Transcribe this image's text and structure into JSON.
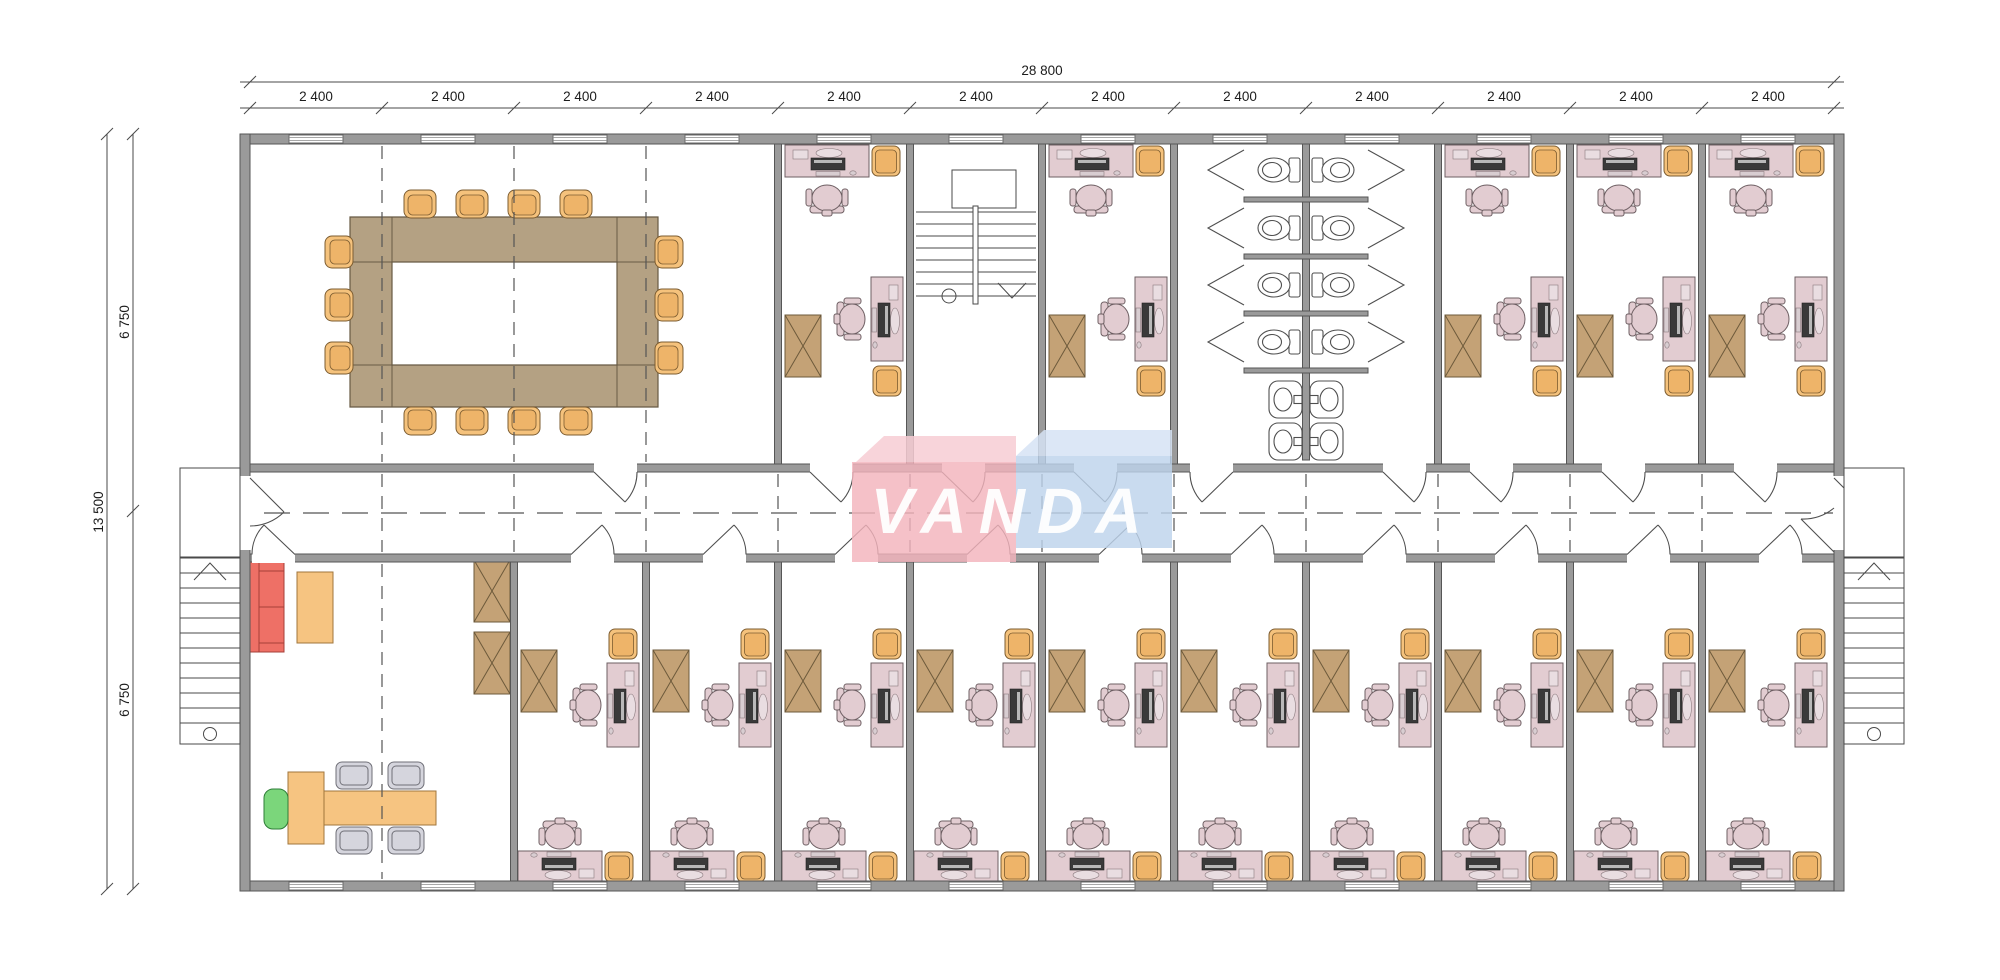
{
  "dimensions": {
    "top_total": "28 800",
    "top_segments": [
      "2 400",
      "2 400",
      "2 400",
      "2 400",
      "2 400",
      "2 400",
      "2 400",
      "2 400",
      "2 400",
      "2 400",
      "2 400",
      "2 400"
    ],
    "left_total": "13 500",
    "left_top": "6 750",
    "left_bottom": "6 750"
  },
  "logo": {
    "text": "VANDA"
  },
  "plan": {
    "overall_width_mm": "28 800",
    "module_width_mm": "2 400",
    "module_count": 12,
    "overall_depth_mm": "13 500",
    "half_depth_mm": "6 750",
    "top_rooms": [
      "conference room (4 modules, table with 14 chairs)",
      "office (desk, task chair, guest chair, wardrobe, side desk)",
      "stairwell (internal stair, down arrow)",
      "office",
      "toilets (2 modules: 8 stalls back-to-back, 4 wash basins)",
      "office",
      "office",
      "office"
    ],
    "bottom_rooms": [
      "reception / lounge (2 modules: sofa, coffee table, manager desk with 4 visitor chairs, 2 wardrobes)",
      "office x10 (wardrobe, side desk, window desk, 2 guest chairs)"
    ],
    "exterior": [
      "entrance stair + landing west",
      "entrance stair + landing east"
    ],
    "corridor": "central corridor with dashed axis line and door swings"
  },
  "palette": {
    "wall": "#9a9a9a",
    "wall_edge": "#565656",
    "line": "#4a4a4a",
    "dash": "#555555",
    "desk": "#e2ccd1",
    "desk_edge": "#6e5f63",
    "desk_monitor": "#3a3a3a",
    "chair_orange": "#f5c27c",
    "chair_orange_in": "#eeb469",
    "chair_orange_edge": "#7c5c30",
    "wardrobe": "#c4a276",
    "wardrobe_edge": "#6d5a3b",
    "conf_table": "#b4a183",
    "conf_table_edge": "#675a44",
    "sofa": "#ee7066",
    "sofa_edge": "#a63f38",
    "table_orange": "#f6c481",
    "table_orange_edge": "#a0763c",
    "chair_green": "#7bd67b",
    "chair_green_edge": "#2f7d38",
    "chair_grey": "#d5d5dd",
    "chair_grey_edge": "#6f6f77",
    "logo_red": "#f3b3bc",
    "logo_red_top": "#f7cdd3",
    "logo_blue": "#bdd3eb",
    "logo_blue_top": "#d6e3f4",
    "logo_text": "#ffffff",
    "dim_text": "#1c1c1c"
  }
}
